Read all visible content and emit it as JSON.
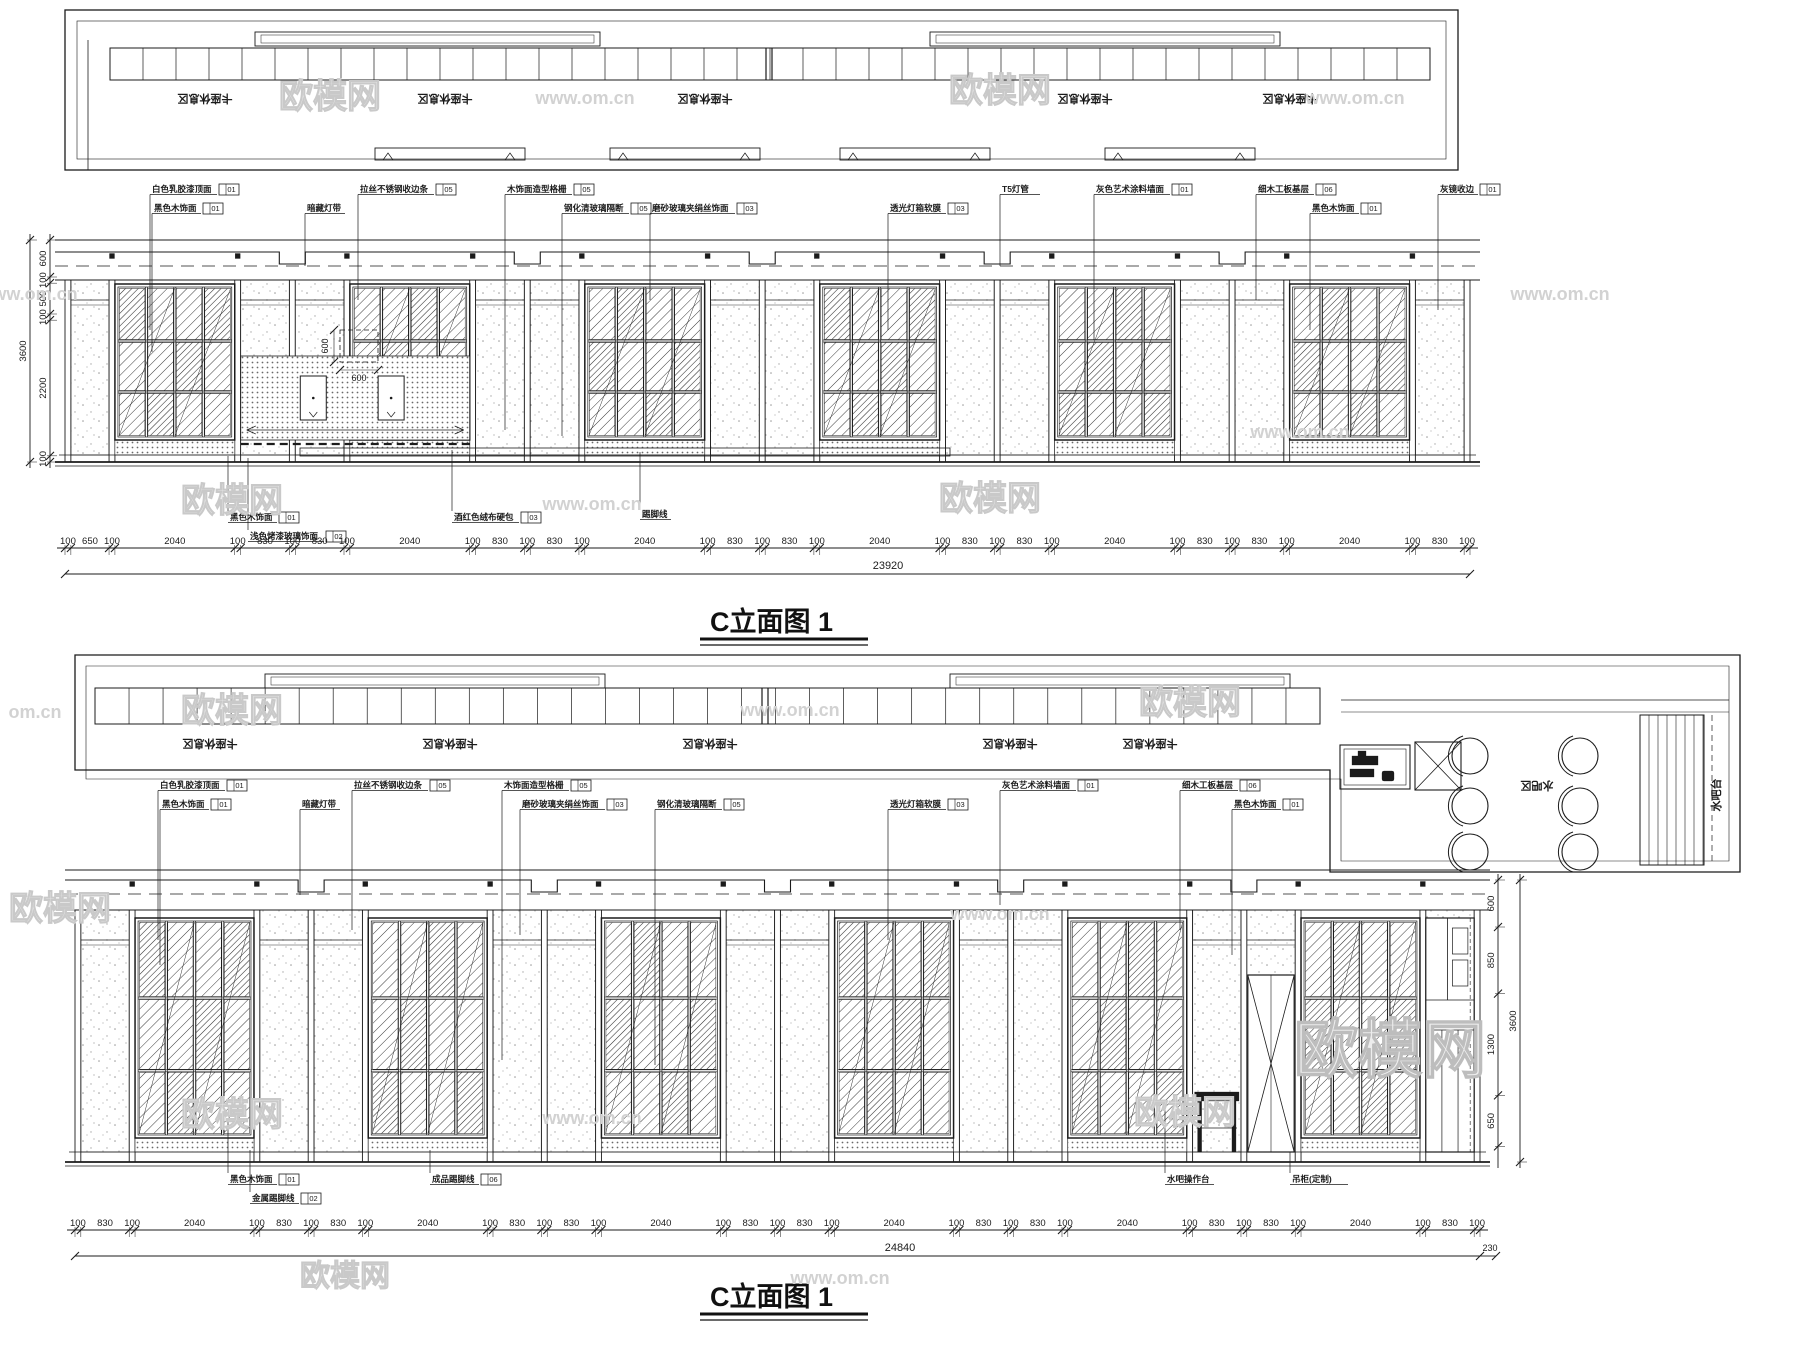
{
  "watermark_brand": "欧模网",
  "watermark_site": "www.om.cn",
  "titles": {
    "elevation1": "C立面图 1",
    "elevation2": "C立面图 1"
  },
  "plan_top": {
    "booth_label": "卡座休息区",
    "booth_label_positions": [
      205,
      445,
      705,
      1085,
      1290
    ]
  },
  "plan_mid": {
    "booth_label": "卡座休息区",
    "booth_label_positions": [
      210,
      450,
      710,
      1010,
      1150
    ],
    "bar_zone_label": "水吧区",
    "bar_counter_label": "水吧台"
  },
  "elevation1": {
    "dims_bottom": [
      "100",
      "650",
      "100",
      "2040",
      "100",
      "830",
      "100",
      "830",
      "100",
      "2040",
      "100",
      "830",
      "100",
      "830",
      "100",
      "2040",
      "100",
      "830",
      "100",
      "830",
      "100",
      "2040",
      "100",
      "830",
      "100",
      "830",
      "100",
      "2040",
      "100",
      "830",
      "100",
      "830",
      "100",
      "2040",
      "100",
      "830",
      "100"
    ],
    "dim_total": "23920",
    "dims_left": [
      "600",
      "100",
      "500",
      "100",
      "2200",
      "100"
    ],
    "dim_left_total": "3600",
    "inset_dim_width": "600",
    "inset_dim_height": "600",
    "callouts_top": [
      {
        "text": "白色乳胶漆顶面",
        "code": "01",
        "x": 150,
        "y": 192,
        "ly": 330
      },
      {
        "text": "黑色木饰面",
        "code": "01",
        "x": 152,
        "y": 211,
        "ly": 352
      },
      {
        "text": "暗藏灯带",
        "code": "",
        "x": 305,
        "y": 211,
        "ly": 266
      },
      {
        "text": "拉丝不锈钢收边条",
        "code": "05",
        "x": 358,
        "y": 192,
        "ly": 300
      },
      {
        "text": "木饰面造型格栅",
        "code": "05",
        "x": 505,
        "y": 192,
        "ly": 430
      },
      {
        "text": "钢化清玻璃隔断",
        "code": "05",
        "x": 562,
        "y": 211,
        "ly": 436
      },
      {
        "text": "磨砂玻璃夹绢丝饰面",
        "code": "03",
        "x": 650,
        "y": 211,
        "ly": 300
      },
      {
        "text": "透光灯箱软膜",
        "code": "03",
        "x": 888,
        "y": 211,
        "ly": 330
      },
      {
        "text": "T5灯管",
        "code": "",
        "x": 1000,
        "y": 192,
        "ly": 266
      },
      {
        "text": "灰色艺术涂料墙面",
        "code": "01",
        "x": 1094,
        "y": 192,
        "ly": 340
      },
      {
        "text": "细木工板基层",
        "code": "06",
        "x": 1256,
        "y": 192,
        "ly": 300
      },
      {
        "text": "黑色木饰面",
        "code": "01",
        "x": 1310,
        "y": 211,
        "ly": 330
      },
      {
        "text": "灰镜收边",
        "code": "01",
        "x": 1438,
        "y": 192,
        "ly": 310
      }
    ],
    "callouts_bottom": [
      {
        "text": "黑色木饰面",
        "code": "01",
        "x": 228,
        "y": 520,
        "ly": 456
      },
      {
        "text": "浅色烤漆玻璃饰面",
        "code": "02",
        "x": 248,
        "y": 539,
        "ly": 458
      },
      {
        "text": "酒红色绒布硬包",
        "code": "03",
        "x": 452,
        "y": 520,
        "ly": 450
      },
      {
        "text": "踢脚线",
        "code": "",
        "x": 640,
        "y": 517,
        "ly": 452
      }
    ]
  },
  "elevation2": {
    "dims_bottom": [
      "100",
      "830",
      "100",
      "2040",
      "100",
      "830",
      "100",
      "830",
      "100",
      "2040",
      "100",
      "830",
      "100",
      "830",
      "100",
      "2040",
      "100",
      "830",
      "100",
      "830",
      "100",
      "2040",
      "100",
      "830",
      "100",
      "830",
      "100",
      "2040",
      "100",
      "830",
      "100",
      "830",
      "100",
      "2040",
      "100",
      "830",
      "100"
    ],
    "dim_total": "24840",
    "dim_right_offset": "230",
    "dims_right": [
      "600",
      "850",
      "1300",
      "650"
    ],
    "dim_right_total": "3600",
    "callouts_top": [
      {
        "text": "白色乳胶漆顶面",
        "code": "01",
        "x": 158,
        "y": 788,
        "ly": 940
      },
      {
        "text": "黑色木饰面",
        "code": "01",
        "x": 160,
        "y": 807,
        "ly": 965
      },
      {
        "text": "暗藏灯带",
        "code": "",
        "x": 300,
        "y": 807,
        "ly": 895
      },
      {
        "text": "拉丝不锈钢收边条",
        "code": "05",
        "x": 352,
        "y": 788,
        "ly": 930
      },
      {
        "text": "木饰面造型格栅",
        "code": "05",
        "x": 502,
        "y": 788,
        "ly": 1060
      },
      {
        "text": "磨砂玻璃夹绢丝饰面",
        "code": "03",
        "x": 520,
        "y": 807,
        "ly": 935
      },
      {
        "text": "钢化清玻璃隔断",
        "code": "05",
        "x": 655,
        "y": 807,
        "ly": 1065
      },
      {
        "text": "透光灯箱软膜",
        "code": "03",
        "x": 888,
        "y": 807,
        "ly": 940
      },
      {
        "text": "灰色艺术涂料墙面",
        "code": "01",
        "x": 1000,
        "y": 788,
        "ly": 905
      },
      {
        "text": "细木工板基层",
        "code": "06",
        "x": 1180,
        "y": 788,
        "ly": 930
      },
      {
        "text": "黑色木饰面",
        "code": "01",
        "x": 1232,
        "y": 807,
        "ly": 955
      }
    ],
    "callouts_bottom": [
      {
        "text": "黑色木饰面",
        "code": "01",
        "x": 228,
        "y": 1182,
        "ly": 1120
      },
      {
        "text": "金属踢脚线",
        "code": "02",
        "x": 250,
        "y": 1201,
        "ly": 1150
      },
      {
        "text": "成品踢脚线",
        "code": "06",
        "x": 430,
        "y": 1182,
        "ly": 1150
      },
      {
        "text": "水吧操作台",
        "code": "",
        "x": 1165,
        "y": 1182,
        "ly": 1105
      },
      {
        "text": "吊柜(定制)",
        "code": "",
        "x": 1290,
        "y": 1182,
        "ly": 1000
      }
    ]
  },
  "watermarks": [
    {
      "kind": "brand",
      "text": "欧模网",
      "x": 330,
      "y": 108,
      "size": 34
    },
    {
      "kind": "url",
      "text": "www.om.cn",
      "x": 585,
      "y": 104,
      "size": 18
    },
    {
      "kind": "brand",
      "text": "欧模网",
      "x": 1000,
      "y": 102,
      "size": 34
    },
    {
      "kind": "url",
      "text": "www.om.cn",
      "x": 1355,
      "y": 104,
      "size": 18
    },
    {
      "kind": "url",
      "text": "www.om.cn",
      "x": 28,
      "y": 300,
      "size": 18
    },
    {
      "kind": "url",
      "text": "www.om.cn",
      "x": 1560,
      "y": 300,
      "size": 18
    },
    {
      "kind": "brand",
      "text": "欧模网",
      "x": 232,
      "y": 512,
      "size": 34
    },
    {
      "kind": "url",
      "text": "www.om.cn",
      "x": 592,
      "y": 510,
      "size": 18
    },
    {
      "kind": "brand",
      "text": "欧模网",
      "x": 990,
      "y": 510,
      "size": 34
    },
    {
      "kind": "url",
      "text": "www.om.cn",
      "x": 1300,
      "y": 438,
      "size": 18
    },
    {
      "kind": "url",
      "text": "om.cn",
      "x": 35,
      "y": 718,
      "size": 18
    },
    {
      "kind": "brand",
      "text": "欧模网",
      "x": 232,
      "y": 722,
      "size": 34
    },
    {
      "kind": "url",
      "text": "www.om.cn",
      "x": 790,
      "y": 716,
      "size": 18
    },
    {
      "kind": "brand",
      "text": "欧模网",
      "x": 1190,
      "y": 714,
      "size": 34
    },
    {
      "kind": "url",
      "text": "www.om.cn",
      "x": 1000,
      "y": 920,
      "size": 18
    },
    {
      "kind": "brand",
      "text": "欧模网",
      "x": 60,
      "y": 920,
      "size": 34
    },
    {
      "kind": "brand",
      "text": "欧模网",
      "x": 232,
      "y": 1126,
      "size": 34
    },
    {
      "kind": "url",
      "text": "www.om.cn",
      "x": 592,
      "y": 1124,
      "size": 18
    },
    {
      "kind": "brand",
      "text": "欧模网",
      "x": 1185,
      "y": 1124,
      "size": 34
    },
    {
      "kind": "brand-big",
      "text": "欧模网",
      "x": 1390,
      "y": 1072,
      "size": 64
    },
    {
      "kind": "brand",
      "text": "欧模网",
      "x": 345,
      "y": 1286,
      "size": 30
    },
    {
      "kind": "url",
      "text": "www.om.cn",
      "x": 840,
      "y": 1284,
      "size": 18
    }
  ]
}
